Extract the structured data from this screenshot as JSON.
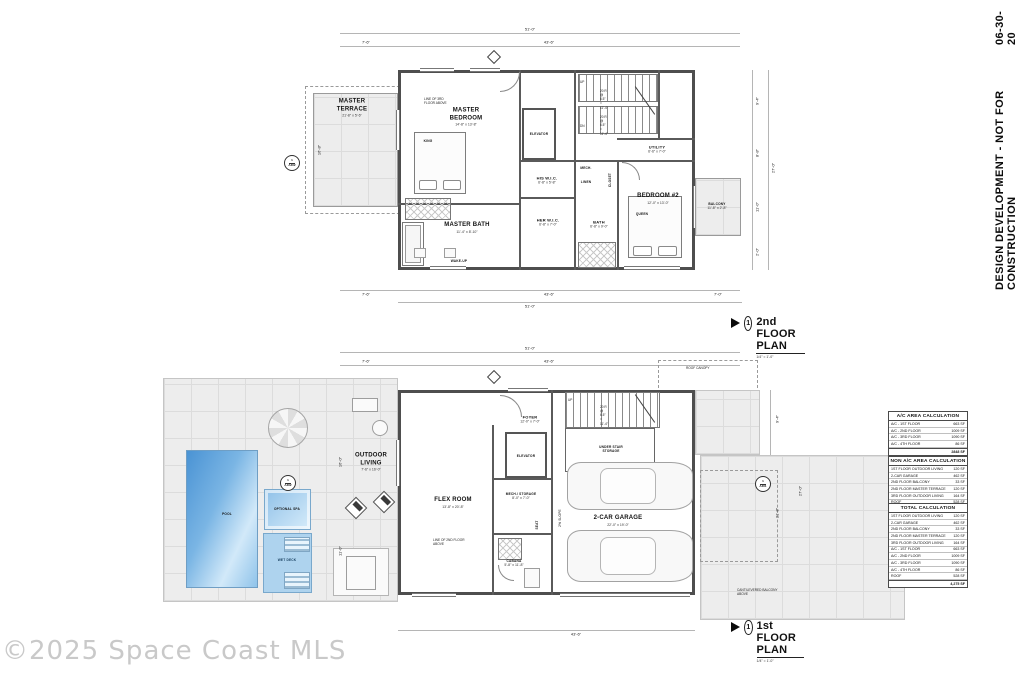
{
  "meta": {
    "stamp_text": "DESIGN DEVELOPMENT - NOT FOR CONSTRUCTION",
    "stamp_date": "06-30-20",
    "watermark": "©2025 Space Coast MLS"
  },
  "plans": {
    "second": {
      "title": "2nd FLOOR PLAN",
      "scale": "1/4\" = 1'-0\"",
      "detail_number": "1",
      "note_line_above": "LINE OF 3RD FLOOR ABOVE",
      "stair_note_up": "20 R @ 6.5\" = 11'-4\"",
      "stair_note_dn": "20 R @ 6.5\" = 11'-4\"",
      "up": "UP",
      "dn": "DN",
      "rooms": {
        "master_terrace": {
          "name": "MASTER TERRACE",
          "dims": "21'-8\" x 5'-6\""
        },
        "master_bedroom": {
          "name": "MASTER BEDROOM",
          "dims": "14'-8\" x 13'-8\""
        },
        "elevator": {
          "name": "ELEVATOR"
        },
        "his_wic": {
          "name": "HIS W.I.C.",
          "dims": "6'-8\" x 5'-8\""
        },
        "mech": {
          "name": "MECH."
        },
        "linen": {
          "name": "LINEN"
        },
        "closet": {
          "name": "CLOSET"
        },
        "her_wic": {
          "name": "HER W.I.C.",
          "dims": "6'-8\" x 7'-0\""
        },
        "master_bath": {
          "name": "MASTER BATH",
          "dims": "11'-4\" x 8'-10\""
        },
        "wake_up": {
          "name": "WAKE-UP"
        },
        "bath": {
          "name": "BATH",
          "dims": "6'-8\" x 9'-0\""
        },
        "bedroom2": {
          "name": "BEDROOM #2",
          "dims": "12'-0\" x 13'-0\""
        },
        "utility": {
          "name": "UTILITY",
          "dims": "6'-6\" x 7'-0\""
        },
        "balcony": {
          "name": "BALCONY",
          "dims": "11'-8\" x 2'-8\""
        }
      },
      "furniture": {
        "king": "KING",
        "queen": "QUEEN"
      },
      "marker": {
        "num": "1",
        "sheet": "A302"
      },
      "dims": {
        "overall_top": "51'-0\"",
        "top_left": "7'-6\"",
        "top_right": "43'-6\"",
        "left": "16'-8\"",
        "right_1": "9'-4\"",
        "right_2": "8'-8\"",
        "right_3": "11'-0\"",
        "right_4": "2'-0\"",
        "right_overall": "27'-0\"",
        "bottom_left": "7'-6\"",
        "bottom_right": "43'-6\"",
        "overall_bottom": "51'-0\"",
        "bottom_side": "7'-0\""
      }
    },
    "first": {
      "title": "1st FLOOR PLAN",
      "scale": "1/4\" = 1'-0\"",
      "detail_number": "1",
      "note_line_above": "LINE OF 2ND FLOOR ABOVE",
      "roof_canopy": "ROOF CANOPY",
      "cantilever": "CANTILEVERED BALCONY ABOVE",
      "slope": "2% SLOPE",
      "stair_note": "20 R @ 6.5\" = 11'-4\"",
      "up": "UP",
      "rooms": {
        "pool": {
          "name": "POOL"
        },
        "optional_spa": {
          "name": "OPTIONAL SPA"
        },
        "wet_deck": {
          "name": "WET DECK"
        },
        "outdoor_living": {
          "name": "OUTDOOR LIVING",
          "dims": "7'-6\" x 16'-0\""
        },
        "flex_room": {
          "name": "FLEX ROOM",
          "dims": "13'-8\" x 20'-8\""
        },
        "foyer": {
          "name": "FOYER",
          "dims": "12'-0\" x 7'-0\""
        },
        "elevator": {
          "name": "ELEVATOR"
        },
        "under_stair": {
          "name": "UNDER STAIR STORAGE"
        },
        "mech_storage": {
          "name": "MECH./ STORAGE",
          "dims": "8'-0\" x 7'-0\""
        },
        "cabana": {
          "name": "CABANA",
          "dims": "5'-8\" x 11'-8\""
        },
        "seat": {
          "name": "SEAT"
        },
        "garage": {
          "name": "2-CAR GARAGE",
          "dims": "22'-0\" x 19'-0\""
        }
      },
      "markers": {
        "deck": {
          "num": "1",
          "sheet": "A302"
        },
        "drive": {
          "num": "1",
          "sheet": "A301"
        }
      },
      "dims": {
        "overall_top": "51'-0\"",
        "top_left": "7'-6\"",
        "top_right": "43'-6\"",
        "left_1": "16'-0\"",
        "left_2": "11'-0\"",
        "right_1": "9'-4\"",
        "right_overall": "27'-0\"",
        "right_2": "21'-8\"",
        "bottom": "43'-6\""
      }
    }
  },
  "tables": [
    {
      "title": "A/C AREA CALCULATION",
      "rows": [
        [
          "A/C - 1ST FLOOR",
          "663 SF"
        ],
        [
          "A/C - 2ND FLOOR",
          "1009 SF"
        ],
        [
          "A/C - 3RD FLOOR",
          "1090 SF"
        ],
        [
          "A/C - 4TH FLOOR",
          "86 SF"
        ]
      ],
      "total": "2848 SF"
    },
    {
      "title": "NON A/C AREA CALCULATION",
      "rows": [
        [
          "1ST FLOOR OUTDOOR LIVING",
          "120 SF"
        ],
        [
          "2-CAR GARAGE",
          "462 SF"
        ],
        [
          "2ND FLOOR BALCONY",
          "33 SF"
        ],
        [
          "2ND FLOOR MASTER TERRACE",
          "120 SF"
        ],
        [
          "3RD FLOOR OUTDOOR LIVING",
          "164 SF"
        ],
        [
          "ROOF",
          "528 SF"
        ]
      ],
      "total": "1427 SF"
    },
    {
      "title": "TOTAL CALCULATION",
      "rows": [
        [
          "1ST FLOOR OUTDOOR LIVING",
          "120 SF"
        ],
        [
          "2-CAR GARAGE",
          "462 SF"
        ],
        [
          "2ND FLOOR BALCONY",
          "33 SF"
        ],
        [
          "2ND FLOOR MASTER TERRACE",
          "120 SF"
        ],
        [
          "3RD FLOOR OUTDOOR LIVING",
          "164 SF"
        ],
        [
          "A/C - 1ST FLOOR",
          "663 SF"
        ],
        [
          "A/C - 2ND FLOOR",
          "1009 SF"
        ],
        [
          "A/C - 3RD FLOOR",
          "1090 SF"
        ],
        [
          "A/C - 4TH FLOOR",
          "86 SF"
        ],
        [
          "ROOF",
          "528 SF"
        ]
      ],
      "total": "4,275 SF"
    }
  ]
}
